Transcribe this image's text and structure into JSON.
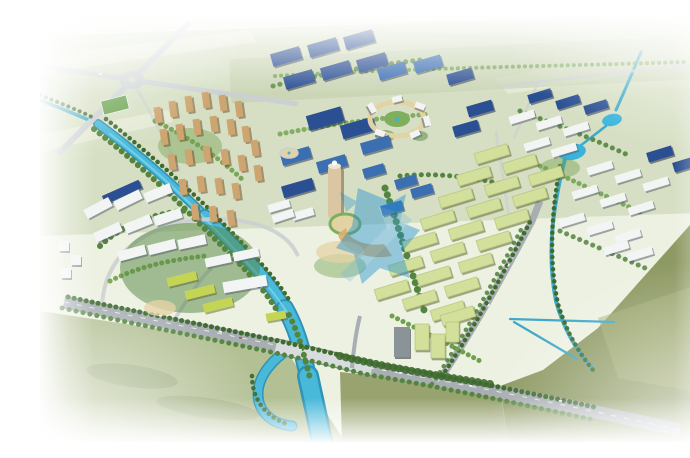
{
  "scene": {
    "type": "aerial architectural rendering",
    "description": "Bird's-eye master-plan rendering of an eco industrial park: a winding bright-blue river, tan residential high-rises, dark-blue-roofed factory halls around a circular landscaped plaza, a cylindrical landmark tower, grids of pale-green row buildings, tree-lined arterial roads, olive farm fields and white-faded edges, with a translucent blue logo watermark at the center.",
    "watermark": {
      "present": true,
      "style": "translucent blue abstract logo",
      "opacity": 0.42
    },
    "regions": [
      "farmland",
      "north industrial district",
      "central ring plaza",
      "landmark tower",
      "residential towers",
      "east industrial campus",
      "rowhouse district",
      "southwest office campus",
      "river and canals",
      "arterial road",
      "green field",
      "watermark"
    ]
  },
  "colors": {
    "bg": "#edf1e2",
    "farmland": "#d6dfc3",
    "farmland_light": "#e4e9d4",
    "haze_green": "#c6d1b0",
    "field_olive": "#8e9a64",
    "field_olive_light": "#a6b077",
    "field_south": "#b3c094",
    "river": "#49b9da",
    "river_deep": "#2e93b6",
    "river_light": "#82d6ec",
    "canal": "#3fa9c8",
    "pond": "#38b4dc",
    "road": "#a8aeb2",
    "road_light": "#cbd0d2",
    "road_dark": "#878f94",
    "tree": "#548540",
    "tree_dark": "#3f6b31",
    "tree_light": "#6fa04e",
    "roof_blue": "#2b4f93",
    "glass_blue": "#3c6fb2",
    "white_roof": "#f3f5f4",
    "residential": "#cda570",
    "rowhouse_roof": "#d3e09c",
    "rowhouse_ridge": "#b3c47c",
    "lime_roof": "#c4d455",
    "sand": "#e3d3a4",
    "lawn": "#7fae5c",
    "tower_body": "#dbc6a4",
    "dark_tower": "#8a9398",
    "watermark": "#1e8ed2",
    "watermark_light": "#59b2e0"
  }
}
